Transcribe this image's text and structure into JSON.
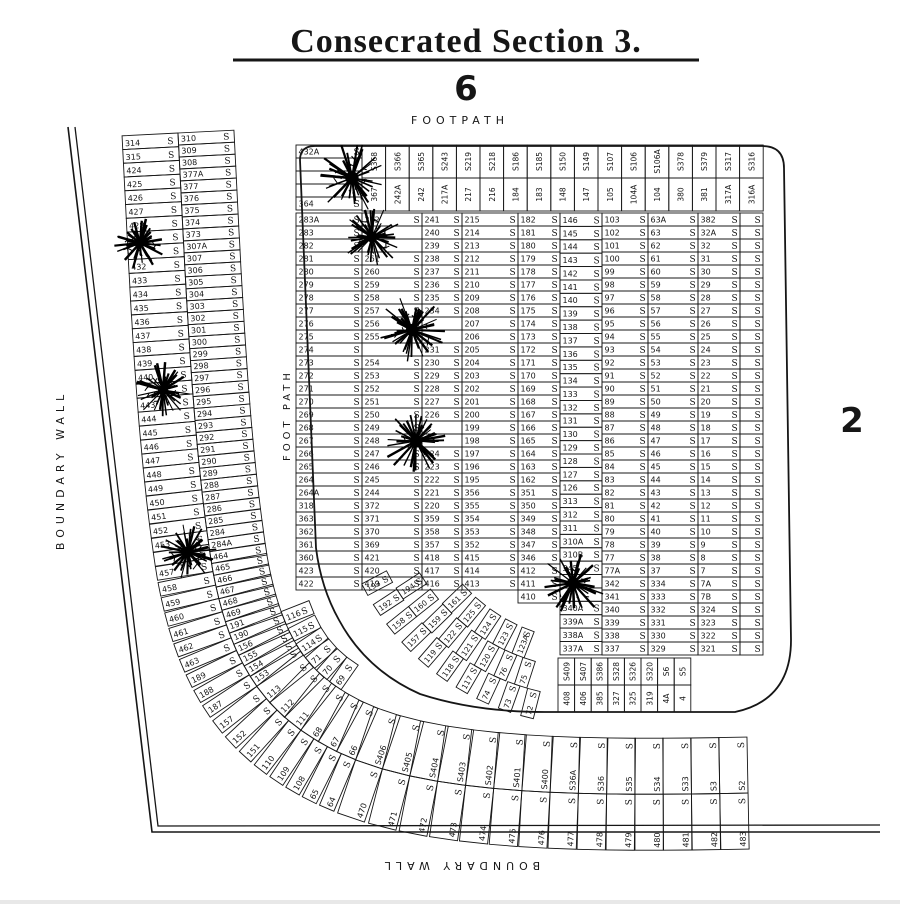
{
  "title": "Consecrated Section 3.",
  "section_number": "6",
  "adjacent_section_number": "2",
  "labels": {
    "footpath_top": "FOOTPATH",
    "footpath_left": "FOOT PATH",
    "boundary_wall_left": "BOUNDARY WALL",
    "boundary_wall_bottom": "BOUNDARY WALL"
  },
  "grave_marker": "S",
  "left_band": {
    "outer": [
      "314",
      "315",
      "424",
      "425",
      "426",
      "427",
      "428",
      null,
      null,
      "432",
      "433",
      "434",
      "435",
      "436",
      "437",
      "438",
      "439",
      "440",
      null,
      "443",
      "444",
      "445",
      "446",
      "447",
      "448",
      "449",
      "450",
      "451",
      "452",
      "453",
      null,
      "457",
      "458",
      "459",
      "460",
      "461",
      "462",
      "463",
      "189",
      "188",
      "187",
      "157",
      "152",
      "151",
      "110",
      "109",
      "108",
      "65",
      "64",
      "470",
      "471",
      "472",
      "473",
      "474",
      "475",
      "476",
      "477",
      "478",
      "479",
      "480",
      "481",
      "482",
      "483"
    ],
    "inner": [
      "310",
      "309",
      "308",
      "377A",
      "377",
      "376",
      "375",
      "374",
      "373",
      "307A",
      "307",
      "306",
      "305",
      "304",
      "303",
      "302",
      "301",
      "300",
      "299",
      "298",
      "297",
      "296",
      "295",
      "294",
      "293",
      "292",
      "291",
      "290",
      "289",
      "288",
      "287",
      "286",
      "285",
      "284",
      "284A",
      "464",
      "465",
      "466",
      "467",
      "468",
      "469",
      "191",
      "190",
      "156",
      "155",
      "154",
      "153",
      "113",
      "112",
      "111",
      "68",
      "67",
      "66",
      "S406",
      "S405",
      "S404",
      "S403",
      "S402",
      "S401",
      "S400",
      "S36A",
      "S36",
      "S35",
      "S34",
      "S33",
      "S3",
      "S2"
    ],
    "extra": [
      "116",
      "115",
      "114",
      "71",
      "70",
      "69"
    ]
  },
  "grid_columns": [
    {
      "x": 296,
      "w": 66,
      "y0": 145,
      "rh": 13.0,
      "plots": [
        "432A",
        null,
        null,
        null,
        "364"
      ]
    },
    {
      "x": 296,
      "w": 66,
      "y0": 213,
      "rh": 13.0,
      "plots": [
        "283A",
        "283",
        "282",
        "281",
        "280",
        "279",
        "278",
        "277",
        "276",
        "275",
        "274",
        "273",
        "272",
        "271",
        "270",
        "269",
        "268",
        "267",
        "266",
        "265",
        "264",
        "264A",
        "318",
        "363",
        "362",
        "361",
        "360",
        "423",
        "422"
      ]
    },
    {
      "x": 362,
      "w": 60,
      "y0": 213,
      "rh": 13.0,
      "plots": [
        "262",
        null,
        null,
        "261",
        "260",
        "259",
        "258",
        "257",
        "256",
        "255",
        null,
        "254",
        "253",
        "252",
        "251",
        "250",
        "249",
        "248",
        "247",
        "246",
        "245",
        "244",
        "372",
        "371",
        "370",
        "369",
        "421",
        "420",
        "419"
      ]
    },
    {
      "x": 422,
      "w": 40,
      "y0": 213,
      "rh": 13.0,
      "plots": [
        "241",
        "240",
        "239",
        "238",
        "237",
        "236",
        "235",
        "234",
        null,
        null,
        "231",
        "230",
        "229",
        "228",
        "227",
        "226",
        null,
        null,
        "224",
        "223",
        "222",
        "221",
        "220",
        "359",
        "358",
        "357",
        "418",
        "417",
        "416"
      ]
    },
    {
      "x": 462,
      "w": 56,
      "y0": 213,
      "rh": 13.0,
      "plots": [
        "215",
        "214",
        "213",
        "212",
        "211",
        "210",
        "209",
        "208",
        "207",
        "206",
        "205",
        "204",
        "203",
        "202",
        "201",
        "200",
        "199",
        "198",
        "197",
        "196",
        "195",
        "356",
        "355",
        "354",
        "353",
        "352",
        "415",
        "414",
        "413"
      ]
    },
    {
      "x": 518,
      "w": 42,
      "y0": 213,
      "rh": 13.0,
      "plots": [
        "182",
        "181",
        "180",
        "179",
        "178",
        "177",
        "176",
        "175",
        "174",
        "173",
        "172",
        "171",
        "170",
        "169",
        "168",
        "167",
        "166",
        "165",
        "164",
        "163",
        "162",
        "351",
        "350",
        "349",
        "348",
        "347",
        "346",
        "412",
        "411",
        "410"
      ]
    },
    {
      "x": 560,
      "w": 42,
      "y0": 213,
      "rh": 13.39,
      "plots": [
        "146",
        "145",
        "144",
        "143",
        "142",
        "141",
        "140",
        "139",
        "138",
        "137",
        "136",
        "135",
        "134",
        "133",
        "132",
        "131",
        "130",
        "129",
        "128",
        "127",
        "126",
        "313",
        "312",
        "311",
        "310A",
        "310B",
        "345",
        null,
        null,
        "340A",
        "339A",
        "338A",
        "337A"
      ]
    },
    {
      "x": 602,
      "w": 46,
      "y0": 213,
      "rh": 13.0,
      "plots": [
        "103",
        "102",
        "101",
        "100",
        "99",
        "98",
        "97",
        "96",
        "95",
        "94",
        "93",
        "92",
        "91",
        "90",
        "89",
        "88",
        "87",
        "86",
        "85",
        "84",
        "83",
        "82",
        "81",
        "80",
        "79",
        "78",
        "77",
        "77A",
        "342",
        "341",
        "340",
        "339",
        "338",
        "337"
      ]
    },
    {
      "x": 648,
      "w": 50,
      "y0": 213,
      "rh": 13.0,
      "plots": [
        "63A",
        "63",
        "62",
        "61",
        "60",
        "59",
        "58",
        "57",
        "56",
        "55",
        "54",
        "53",
        "52",
        "51",
        "50",
        "49",
        "48",
        "47",
        "46",
        "45",
        "44",
        "43",
        "42",
        "41",
        "40",
        "39",
        "38",
        "37",
        "334",
        "333",
        "332",
        "331",
        "330",
        "329"
      ]
    },
    {
      "x": 698,
      "w": 42,
      "y0": 213,
      "rh": 13.0,
      "plots": [
        "382",
        "32A",
        "32",
        "31",
        "30",
        "29",
        "28",
        "27",
        "26",
        "25",
        "24",
        "23",
        "22",
        "21",
        "20",
        "19",
        "18",
        "17",
        "16",
        "15",
        "14",
        "13",
        "12",
        "11",
        "10",
        "9",
        "8",
        "7",
        "7A",
        "7B",
        "324",
        "323",
        "322",
        "321"
      ]
    },
    {
      "x": 740,
      "w": 23,
      "y0": 213,
      "rh": 13.0,
      "s_only": 34,
      "plots": []
    }
  ],
  "top_row_pairs": [
    [
      "367",
      "S368"
    ],
    [
      "242A",
      "S366"
    ],
    [
      "242",
      "S365"
    ],
    [
      "217A",
      "S243"
    ],
    [
      "217",
      "S219"
    ],
    [
      "216",
      "S218"
    ],
    [
      "184",
      "S186"
    ],
    [
      "183",
      "S185"
    ],
    [
      "148",
      "S150"
    ],
    [
      "147",
      "S149"
    ],
    [
      "105",
      "S107"
    ],
    [
      "104A",
      "S106"
    ],
    [
      "104",
      "S106A"
    ],
    [
      "380",
      "S378"
    ],
    [
      "381",
      "S379"
    ],
    [
      "317A",
      "S317"
    ],
    [
      "316A",
      "S316"
    ]
  ],
  "bottom_vertical_pairs": [
    [
      "408",
      "S409"
    ],
    [
      "406",
      "S407"
    ],
    [
      "385",
      "S386"
    ],
    [
      "327",
      "S328"
    ],
    [
      "325",
      "S326"
    ],
    [
      "319",
      "S320"
    ],
    [
      "4A",
      "S6"
    ],
    [
      "4",
      "S5"
    ]
  ],
  "fan_rings": [
    {
      "r_out": 255,
      "theta0": 152,
      "dtheta": -5.3,
      "numbers": [
        "193",
        "192",
        "158",
        "157",
        "119",
        "118",
        "117",
        "74",
        "73",
        "72"
      ]
    },
    {
      "r_out": 227,
      "theta0": 147,
      "dtheta": -5.6,
      "numbers": [
        "194",
        "160",
        "159",
        "122",
        "121",
        "120",
        "76",
        "75"
      ]
    },
    {
      "r_out": 199,
      "theta0": 136,
      "dtheta": -6.2,
      "numbers": [
        "161",
        "125",
        "124",
        "123",
        "123A"
      ]
    }
  ],
  "trees": [
    {
      "x": 140,
      "y": 243,
      "r": 27
    },
    {
      "x": 163,
      "y": 390,
      "r": 28
    },
    {
      "x": 188,
      "y": 552,
      "r": 29
    },
    {
      "x": 352,
      "y": 178,
      "r": 37
    },
    {
      "x": 372,
      "y": 237,
      "r": 30
    },
    {
      "x": 412,
      "y": 330,
      "r": 34
    },
    {
      "x": 416,
      "y": 441,
      "r": 34
    },
    {
      "x": 573,
      "y": 583,
      "r": 33
    }
  ],
  "ink_color": "#161616"
}
